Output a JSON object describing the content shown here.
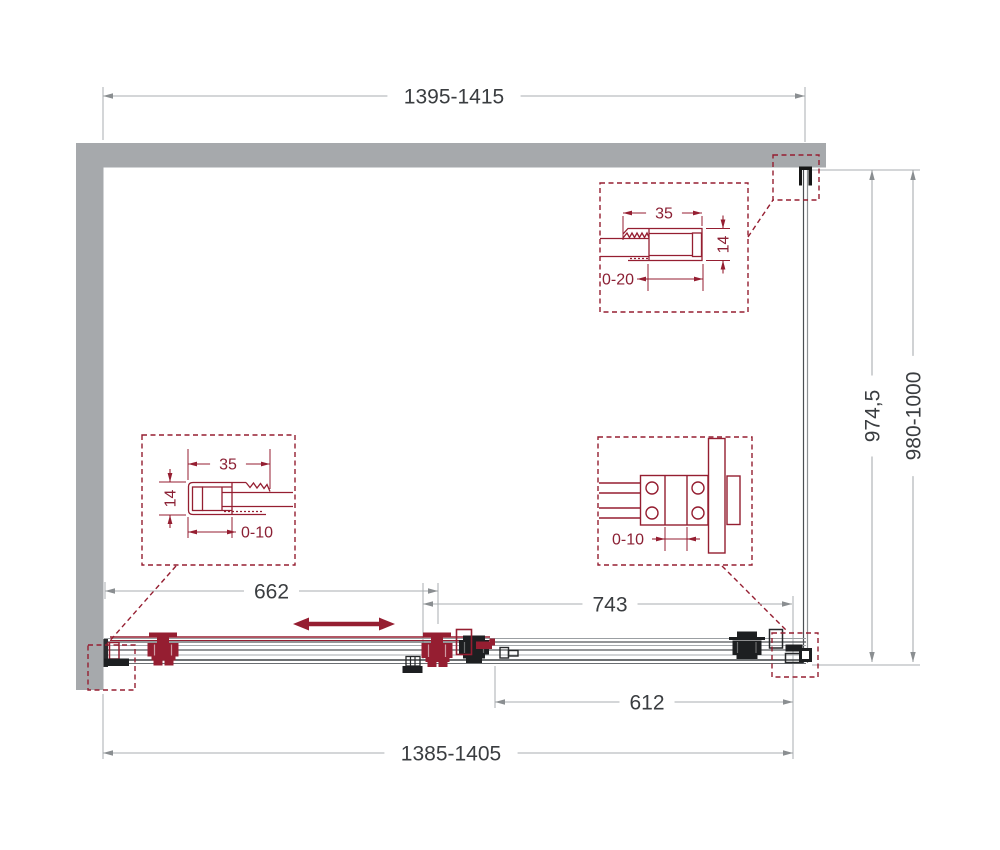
{
  "drawing": {
    "type": "shower-enclosure-plan-view",
    "dimensions": {
      "top_width": "1395-1415",
      "glass_height": "974,5",
      "total_height": "980-1000",
      "left_door_width": "662",
      "right_panel_width": "743",
      "fixed_glass_width": "612",
      "bottom_width": "1385-1405"
    },
    "details": {
      "top_wall_profile": {
        "width": "35",
        "depth": "14",
        "adjustment": "0-20"
      },
      "left_wall_profile": {
        "width": "35",
        "depth": "14",
        "adjustment": "0-10"
      },
      "panel_connector": {
        "adjustment": "0-10"
      }
    },
    "colors": {
      "accent_red": "#951E31",
      "detail_text_red": "#8B2034",
      "wall_gray": "#A6A9AC",
      "dim_line_gray": "#A9ADB0",
      "dim_text": "#3A3D40"
    }
  }
}
